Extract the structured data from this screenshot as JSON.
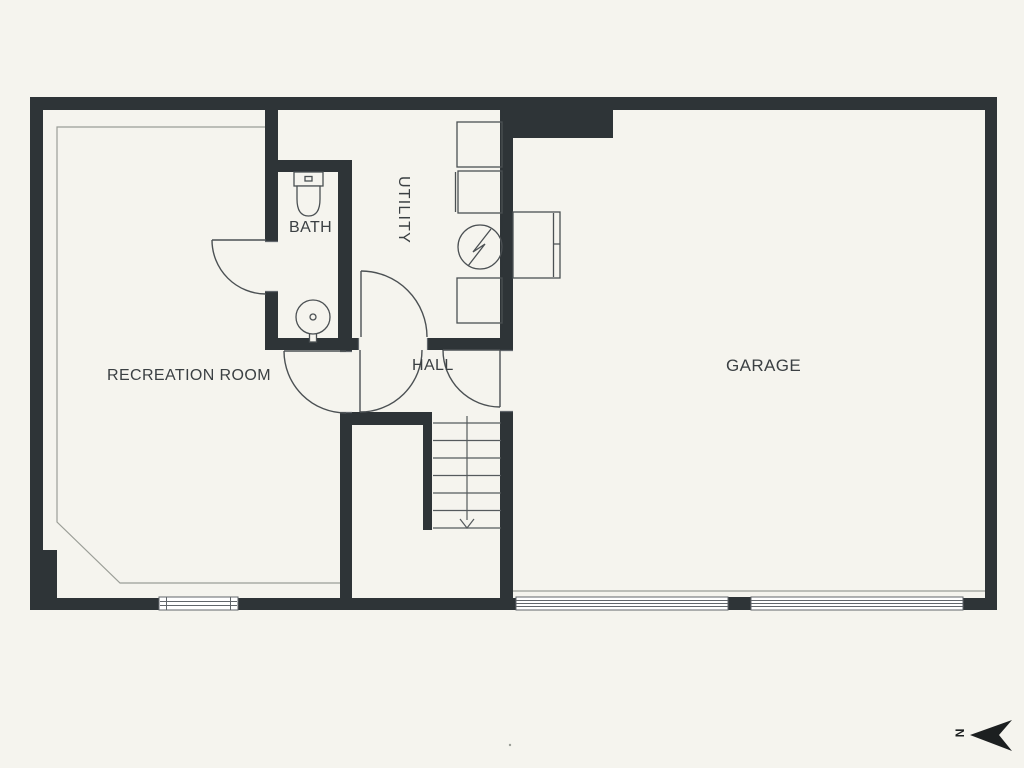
{
  "page": {
    "background_color": "#f5f4ee"
  },
  "floorplan": {
    "type": "basement-floor-plan",
    "colors": {
      "wall": "#2e3437",
      "fixture_line": "#4b5053",
      "thin_line": "#9b9e97",
      "window_line": "#61666b",
      "text": "#3b4043",
      "compass": "#1c1f20"
    },
    "rooms": [
      {
        "id": "recreation-room",
        "label": "RECREATION ROOM"
      },
      {
        "id": "bath",
        "label": "BATH"
      },
      {
        "id": "utility",
        "label": "UTILITY"
      },
      {
        "id": "hall",
        "label": "HALL"
      },
      {
        "id": "garage",
        "label": "GARAGE"
      }
    ],
    "fixtures": [
      {
        "name": "toilet",
        "room": "bath"
      },
      {
        "name": "pedestal-sink",
        "room": "bath"
      },
      {
        "name": "appliance",
        "room": "utility"
      },
      {
        "name": "appliance",
        "room": "utility"
      },
      {
        "name": "electrical-panel",
        "room": "utility"
      },
      {
        "name": "appliance",
        "room": "utility"
      },
      {
        "name": "water-tank",
        "room": "garage"
      }
    ],
    "stairs": {
      "location": "hall",
      "direction": "down",
      "treads": 6
    },
    "windows": [
      {
        "room": "recreation-room",
        "wall": "south"
      }
    ],
    "garage_door_openings": 2,
    "compass": {
      "letter": "N",
      "points": "left"
    }
  }
}
